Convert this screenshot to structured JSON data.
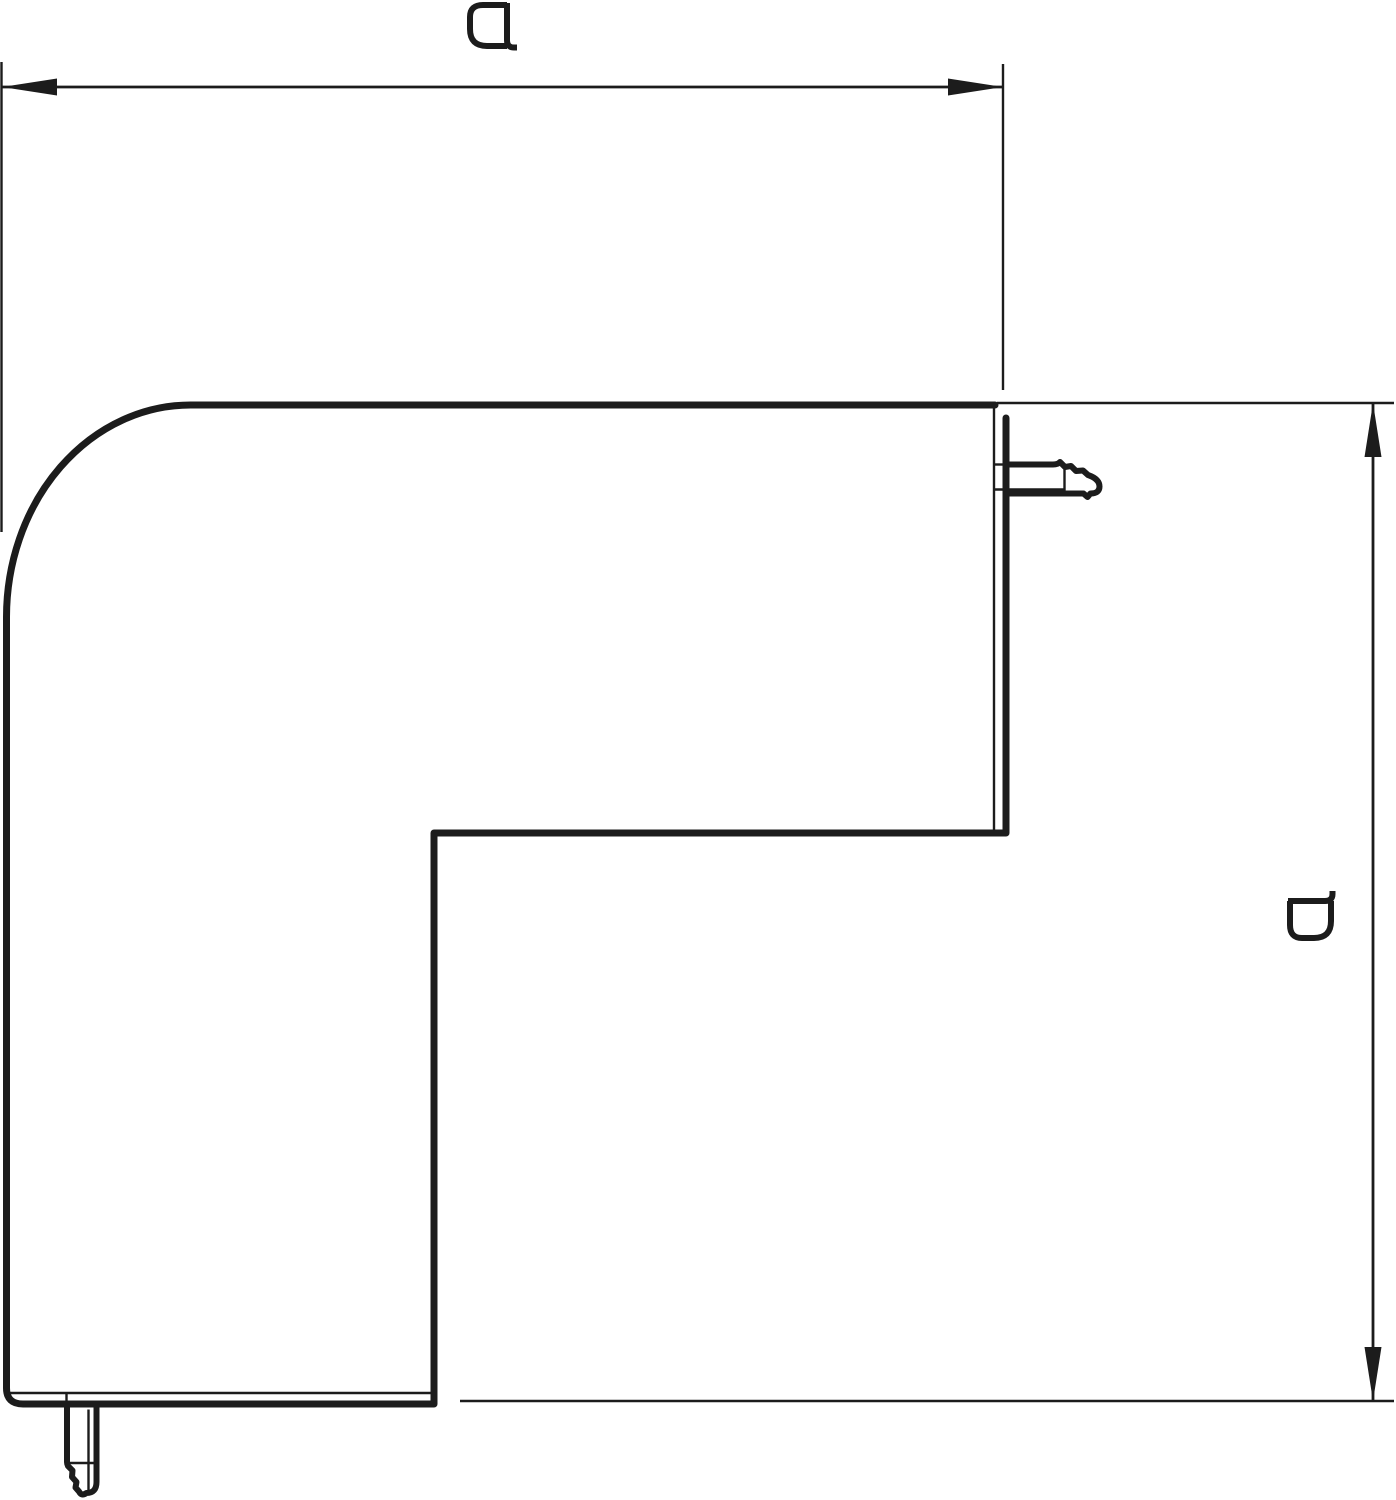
{
  "drawing": {
    "background_color": "#ffffff",
    "line_color": "#1c1c1c",
    "horizontal_dimension": {
      "label": "a"
    },
    "vertical_dimension": {
      "label": "a"
    }
  }
}
